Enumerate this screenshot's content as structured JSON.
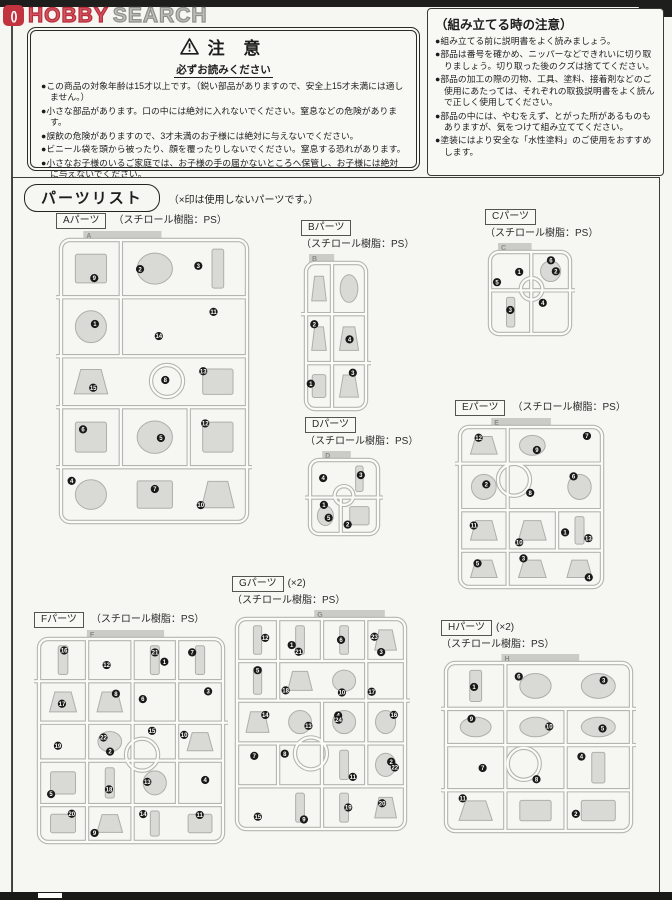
{
  "watermark": {
    "icon_marks": "()",
    "word1": "HOBBY",
    "word2": "SEARCH"
  },
  "caution_box": {
    "title": "注 意",
    "subtitle": "必ずお読みください",
    "bullets": [
      "●この商品の対象年齢は15才以上です。（鋭い部品がありますので、安全上15才未満には適しません。）",
      "●小さな部品があります。口の中には絶対に入れないでください。窒息などの危険があります。",
      "●誤飲の危険がありますので、3才未満のお子様には絶対に与えないでください。",
      "●ビニール袋を頭から被ったり、顔を覆ったりしないでください。窒息する恐れがあります。",
      "●小さなお子様のいるご家庭では、お子様の手の届かないところへ保管し、お子様には絶対に与えないでください。"
    ]
  },
  "assembly_box": {
    "title": "（組み立てる時の注意）",
    "bullets": [
      "●組み立てる前に説明書をよく読みましょう。",
      "●部品は番号を確かめ、ニッパーなどできれいに切り取りましょう。切り取った後のクズは捨ててください。",
      "●部品の加工の際の刃物、工具、塗料、接着剤などのご使用にあたっては、それぞれの取扱説明書をよく読んで正しく使用してください。",
      "●部品の中には、やむをえず、とがった所があるものもありますが、気をつけて組み立ててください。",
      "●塗装にはより安全な「水性塗料」のご使用をおすすめします。"
    ]
  },
  "parts_list": {
    "title": "パーツリスト",
    "note": "（×印は使用しないパーツです。）",
    "sprues": [
      {
        "letter": "A",
        "name": "Aパーツ",
        "qty": "",
        "material": "（スチロール樹脂：PS）",
        "parts_count": 15
      },
      {
        "letter": "B",
        "name": "Bパーツ",
        "qty": "",
        "material": "（スチロール樹脂：PS）",
        "parts_count": 4
      },
      {
        "letter": "C",
        "name": "Cパーツ",
        "qty": "",
        "material": "（スチロール樹脂：PS）",
        "parts_count": 6
      },
      {
        "letter": "D",
        "name": "Dパーツ",
        "qty": "",
        "material": "（スチロール樹脂：PS）",
        "parts_count": 5
      },
      {
        "letter": "E",
        "name": "Eパーツ",
        "qty": "",
        "material": "（スチロール樹脂：PS）",
        "parts_count": 13
      },
      {
        "letter": "F",
        "name": "Fパーツ",
        "qty": "",
        "material": "（スチロール樹脂：PS）",
        "parts_count": 22
      },
      {
        "letter": "G",
        "name": "Gパーツ",
        "qty": "(×2)",
        "material": "（スチロール樹脂：PS）",
        "parts_count": 24
      },
      {
        "letter": "H",
        "name": "Hパーツ",
        "qty": "(×2)",
        "material": "（スチロール樹脂：PS）",
        "parts_count": 11
      }
    ]
  },
  "colors": {
    "accent_red": "#c23340",
    "runner_gray": "#b4b4b0",
    "part_fill": "#d9d9d5",
    "ink": "#1d1d1b"
  }
}
